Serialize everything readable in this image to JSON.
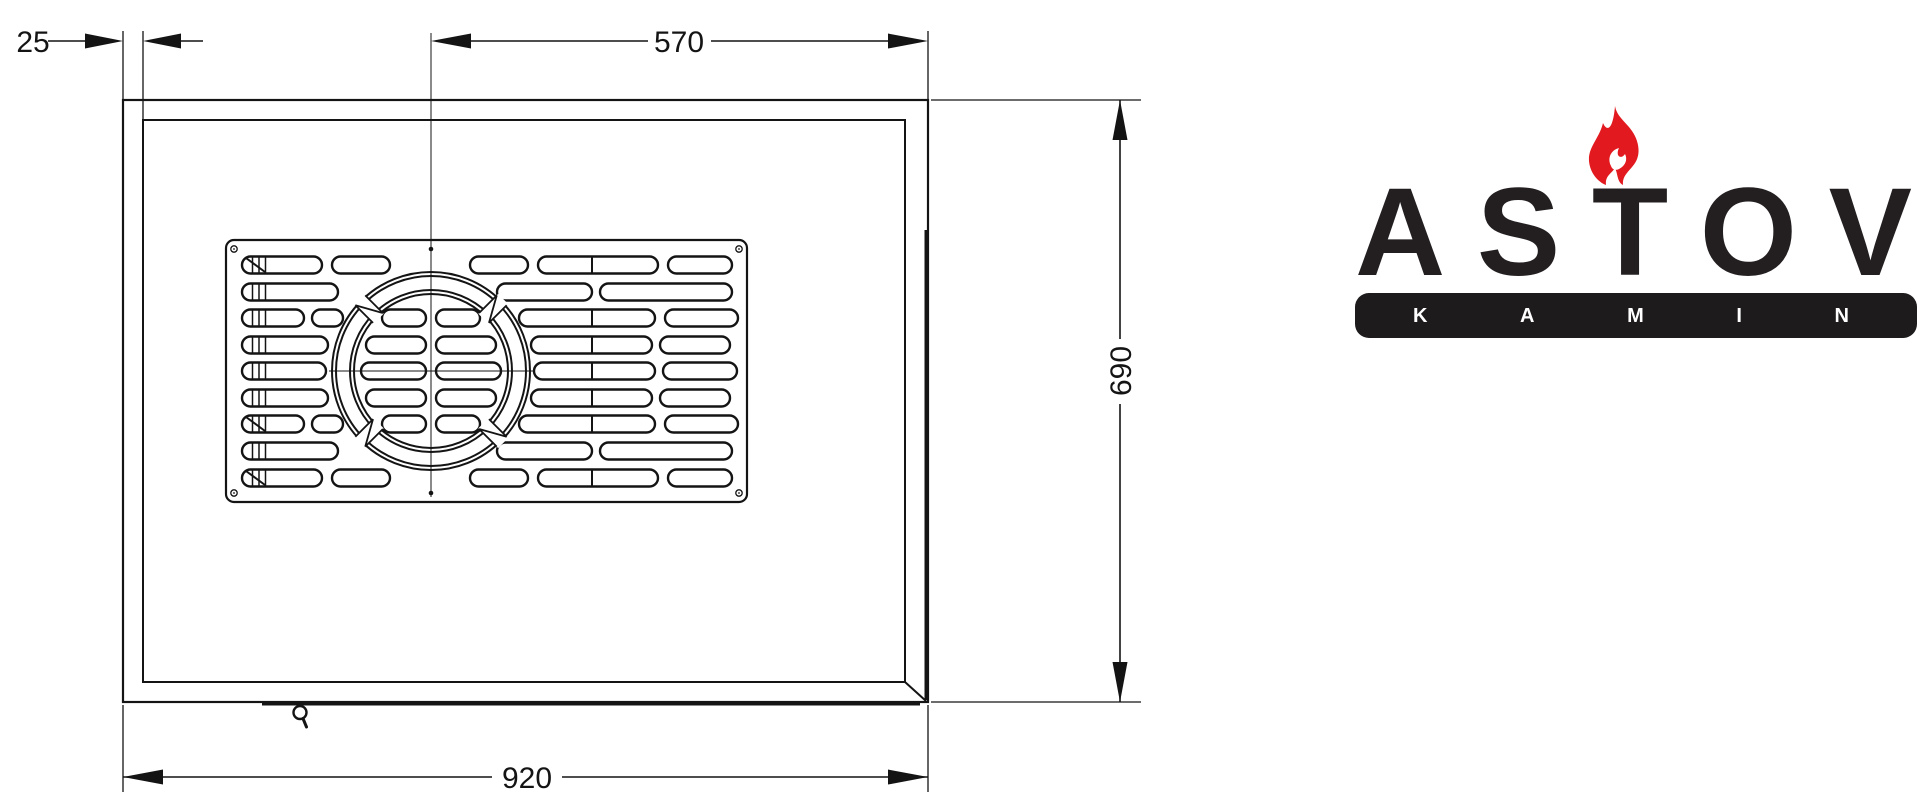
{
  "title": "ASTOV kamin top view technical drawing",
  "drawing": {
    "line_color": "#141414",
    "dimensions": {
      "wall": {
        "label": "25",
        "value": 25
      },
      "flue_center_offset": {
        "label": "570",
        "value": 570
      },
      "depth": {
        "label": "690",
        "value": 690
      },
      "width": {
        "label": "920",
        "value": 920
      }
    },
    "grille": {
      "plate": {
        "x": 226,
        "y": 240,
        "w": 521,
        "h": 262,
        "rx": 8
      },
      "circle": {
        "cx": 431,
        "cy": 371,
        "radii": [
          99,
          95,
          81,
          77
        ],
        "gap_angles": [
          45,
          135,
          225,
          315
        ]
      },
      "pill_height": 17,
      "rows": [
        {
          "y": 265,
          "diag": true,
          "pills": [
            [
              242,
              322
            ],
            [
              332,
              390
            ],
            [
              470,
              528
            ],
            [
              538,
              658
            ],
            [
              668,
              732
            ]
          ],
          "dividers": [
            592
          ]
        },
        {
          "y": 292,
          "diag": false,
          "pills": [
            [
              242,
              338
            ],
            [
              497,
              592
            ],
            [
              600,
              732
            ]
          ],
          "dividers": []
        },
        {
          "y": 318,
          "diag": false,
          "pills": [
            [
              242,
              304
            ],
            [
              312,
              343
            ],
            [
              382,
              426
            ],
            [
              436,
              480
            ],
            [
              519,
              655
            ],
            [
              665,
              738
            ]
          ],
          "dividers": [
            592
          ]
        },
        {
          "y": 345,
          "diag": false,
          "pills": [
            [
              242,
              328
            ],
            [
              366,
              426
            ],
            [
              436,
              496
            ],
            [
              531,
              652
            ],
            [
              660,
              730
            ]
          ],
          "dividers": [
            592
          ]
        },
        {
          "y": 371,
          "diag": false,
          "pills": [
            [
              242,
              326
            ],
            [
              361,
              426
            ],
            [
              436,
              501
            ],
            [
              534,
              655
            ],
            [
              663,
              737
            ]
          ],
          "dividers": [
            592
          ]
        },
        {
          "y": 398,
          "diag": false,
          "pills": [
            [
              242,
              328
            ],
            [
              366,
              426
            ],
            [
              436,
              496
            ],
            [
              531,
              652
            ],
            [
              660,
              730
            ]
          ],
          "dividers": [
            592
          ]
        },
        {
          "y": 424,
          "diag": true,
          "pills": [
            [
              242,
              304
            ],
            [
              312,
              343
            ],
            [
              382,
              426
            ],
            [
              436,
              480
            ],
            [
              519,
              655
            ],
            [
              665,
              738
            ]
          ],
          "dividers": [
            592
          ]
        },
        {
          "y": 451,
          "diag": false,
          "pills": [
            [
              242,
              338
            ],
            [
              497,
              592
            ],
            [
              600,
              732
            ]
          ],
          "dividers": []
        },
        {
          "y": 478,
          "diag": true,
          "pills": [
            [
              242,
              322
            ],
            [
              332,
              390
            ],
            [
              470,
              528
            ],
            [
              538,
              658
            ],
            [
              668,
              732
            ]
          ],
          "dividers": [
            592
          ]
        }
      ],
      "slider_lines_x": [
        252.5,
        259,
        265.5
      ],
      "screws_open": [
        [
          234,
          249
        ],
        [
          739,
          249
        ],
        [
          234,
          493
        ],
        [
          739,
          493
        ]
      ],
      "screws_filled": [
        [
          431,
          249
        ],
        [
          431,
          493
        ]
      ]
    }
  },
  "logo": {
    "brand": "ASTOV",
    "sub": "KAMIN",
    "letters": [
      "A",
      "S",
      "T",
      "O",
      "V"
    ],
    "sub_letters": [
      "K",
      "A",
      "M",
      "I",
      "N"
    ],
    "flame_color": "#e2191e",
    "text_color": "#231f20",
    "bar_color": "#1d1b1c"
  }
}
